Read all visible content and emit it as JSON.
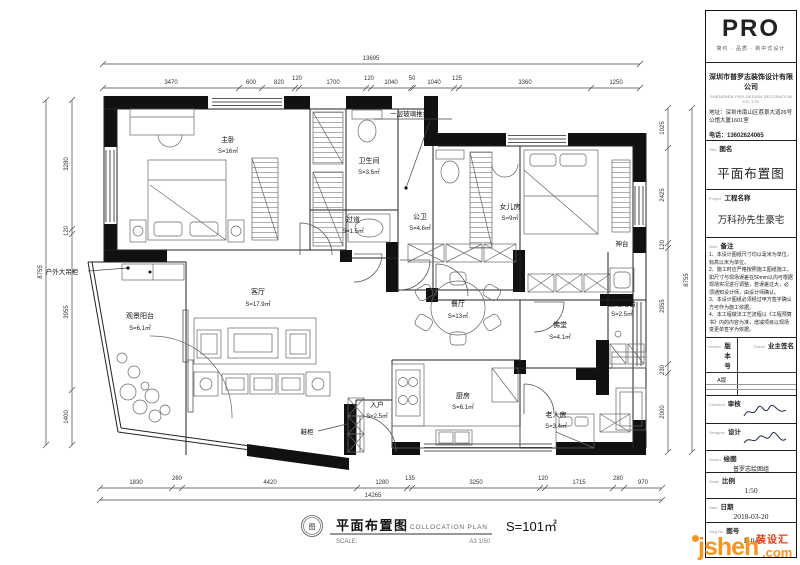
{
  "plan": {
    "rooms": [
      {
        "name": "主卧",
        "area": "S=16㎡"
      },
      {
        "name": "卫生间",
        "area": "S=3.6㎡"
      },
      {
        "name": "过道",
        "area": "S=1.5㎡"
      },
      {
        "name": "公卫",
        "area": "S=4.6㎡"
      },
      {
        "name": "女儿房",
        "area": "S=9㎡"
      },
      {
        "name": "客厅",
        "area": "S=17.9㎡"
      },
      {
        "name": "餐厅",
        "area": "S=13㎡"
      },
      {
        "name": "生活阳台",
        "area": "S=2.5㎡"
      },
      {
        "name": "佛堂",
        "area": "S=4.1㎡"
      },
      {
        "name": "厨房",
        "area": "S=6.1㎡"
      },
      {
        "name": "老人房",
        "area": "S=3.4㎡"
      },
      {
        "name": "观景阳台",
        "area": "S=6.1㎡"
      },
      {
        "name": "入户",
        "area": "S=2.5㎡"
      }
    ],
    "annotations": {
      "glass_door": "一层玻璃推拉门",
      "outdoor_cabinet": "户外大吊柜",
      "shoe_cabinet": "鞋柜",
      "altar": "神台"
    },
    "dims": {
      "top_total": "13695",
      "top": [
        "3470",
        "600",
        "820",
        "120",
        "1700",
        "120",
        "1040",
        "50",
        "1040",
        "125",
        "3360",
        "1250"
      ],
      "bottom": [
        "1830",
        "260",
        "4420",
        "1280",
        "135",
        "3250",
        "120",
        "1715",
        "280",
        "970"
      ],
      "bottom_total": "14265",
      "left_total": "8755",
      "left": [
        "3280",
        "120",
        "3955",
        "1400"
      ],
      "right": [
        "1025",
        "2425",
        "120",
        "2955",
        "230",
        "2000"
      ],
      "right_total": "8755"
    },
    "caption": {
      "badge": "图",
      "title": "平面布置图",
      "subtitle": "COLLOCATION PLAN",
      "scale_label": "SCALE:",
      "scale_value": "A3 1/50",
      "area": "S=101㎡"
    }
  },
  "titleblock": {
    "logo": "PRO",
    "slogan": "简约 · 品质 · 新中式设计",
    "company": "深圳市普罗志装饰设计有限公司",
    "company_en": "SHENZHEN PRO-DESIGN DECORATION CO.,LTD",
    "address": "地址：深圳市南山区荔景大道26号公馆大厦1601室",
    "phone": "电话：13602624065",
    "fields": {
      "title_en": "Title",
      "title_label": "图名",
      "title_value": "平面布置图",
      "project_en": "Project",
      "project_label": "工程名称",
      "project_value": "万科孙先生豪宅",
      "note_en": "Note",
      "note_label": "备注",
      "notes": [
        "1、本设计图纸尺寸均以毫米为单位，标高以米为单位。",
        "2、施工时应严格按照施工图纸施工，如尺寸与现场误差在50mm以内可根据现场实况进行调整，若误差过大，必须通知设计师，由设计师确认。",
        "3、本设计图纸必须经过甲方签字确认方可作为施工依据。",
        "4、本工程做法工艺流程以《工程预算书》内的内容为准，增减项目以现场变更单签字为依据。"
      ],
      "version_en": "Version",
      "version_label": "版本号",
      "version_value": "A版",
      "owner_en": "Owner",
      "owner_label": "业主签名",
      "checked_en": "Checked",
      "checked_label": "审核",
      "designer_en": "Designer",
      "designer_label": "设计",
      "drawn_en": "Drawn",
      "drawn_label": "绘图",
      "drawn_value": "普罗志绘图组",
      "scale_en": "Scale",
      "scale_label": "比例",
      "scale_value": "1:50",
      "date_en": "Date",
      "date_label": "日期",
      "date_value": "2018-03-20",
      "dwg_en": "Dwg No",
      "dwg_label": "图号",
      "dwg_value": "P-04"
    }
  },
  "watermark": {
    "brand": "jsheh",
    "tld": ".com",
    "cn": "装设汇"
  }
}
